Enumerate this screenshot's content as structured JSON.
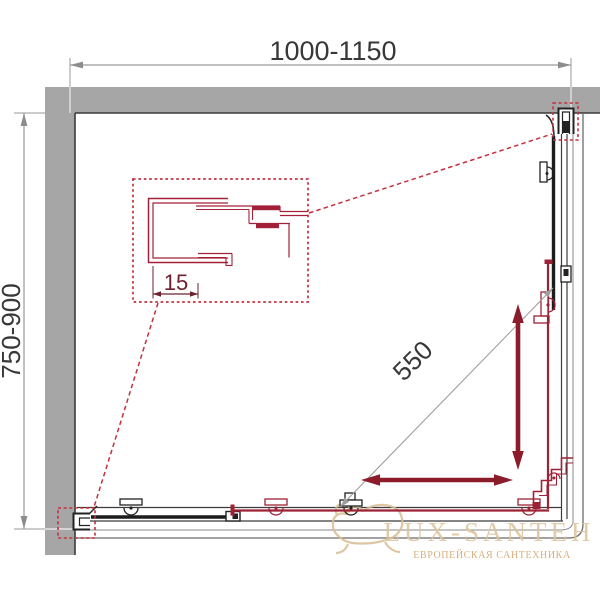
{
  "drawing": {
    "title": "shower-enclosure-plan-view",
    "dimensions": {
      "width": "1000-1150",
      "depth": "750-900",
      "diagonal_entry": "550",
      "profile_adjustment": "15"
    },
    "watermark": {
      "brand": "LUX-SANTEH",
      "tagline": "ЕВРОПЕЙСКАЯ САНТЕХНИКА",
      "icon": "bathtub-icon"
    },
    "colors": {
      "wall_gray": "#a6a6a6",
      "outline_dark": "#3a3a3a",
      "dimension_gray": "#9a9a9a",
      "callout_red": "#c5303c",
      "door_red": "#9e2235",
      "profile_red": "#a32138",
      "arrow_maroon": "#8c1c2c",
      "watermark_tan": "#dcc49c",
      "watermark_tagline_tan": "#cfa267"
    }
  }
}
